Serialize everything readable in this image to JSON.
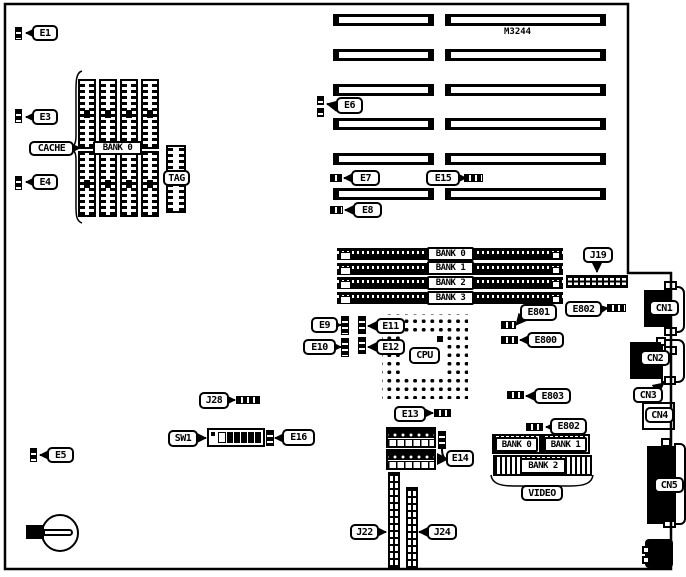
{
  "board": {
    "chip_label": "M3244",
    "ink_color": "#000000",
    "paper_color": "#ffffff"
  },
  "labels": {
    "e1": "E1",
    "e3": "E3",
    "e4": "E4",
    "e5": "E5",
    "e6": "E6",
    "e7": "E7",
    "e8": "E8",
    "e9": "E9",
    "e10": "E10",
    "e11": "E11",
    "e12": "E12",
    "e13": "E13",
    "e14": "E14",
    "e15": "E15",
    "e16": "E16",
    "e800": "E800",
    "e801": "E801",
    "e802a": "E802",
    "e802b": "E802",
    "e803": "E803",
    "j19": "J19",
    "j22": "J22",
    "j24": "J24",
    "j28": "J28",
    "sw1": "SW1",
    "cache": "CACHE",
    "cache_bank": "BANK 0",
    "tag": "TAG",
    "cpu": "CPU",
    "video": "VIDEO",
    "cn1": "CN1",
    "cn2": "CN2",
    "cn3": "CN3",
    "cn4": "CN4",
    "cn5": "CN5"
  },
  "memory_banks": [
    "BANK 0",
    "BANK 1",
    "BANK 2",
    "BANK 3"
  ],
  "video_banks": [
    "BANK 0",
    "BANK 1",
    "BANK 2"
  ]
}
